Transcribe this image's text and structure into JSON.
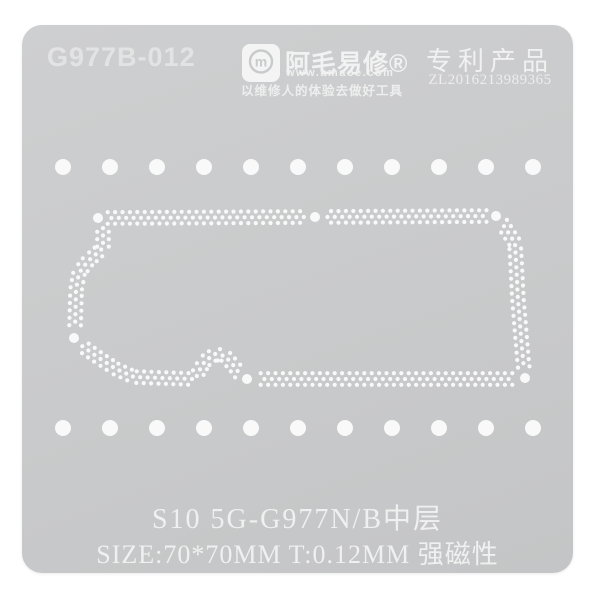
{
  "header": {
    "model_code": "G977B-012",
    "brand": {
      "logo_letter": "m",
      "name": "阿毛易修®",
      "website": "www.amaoe.com",
      "slogan": "以维修人的体验去做好工具"
    },
    "patent_label": "专利产品",
    "patent_number": "ZL2016213989365"
  },
  "caption": {
    "line1": "S10 5G-G977N/B中层",
    "line2": "SIZE:70*70MM T:0.12MM 强磁性"
  },
  "colors": {
    "background": "#ffffff",
    "plate_gray": "#c9cacb",
    "hole_white": "#f9f9f9",
    "text_white": "#f0f0f0"
  },
  "stencil": {
    "hole_rows": {
      "y": [
        167,
        428
      ],
      "x_start": 63,
      "x_step": 47,
      "count": 11,
      "r": 8
    },
    "big_dot_r": 5,
    "big_dots": [
      [
        98,
        218
      ],
      [
        315,
        217
      ],
      [
        496,
        216
      ],
      [
        74,
        338
      ],
      [
        247,
        379
      ],
      [
        525,
        378
      ]
    ],
    "small_dot_r": 2.1,
    "step": 3.7,
    "lane_offset": 5.8,
    "clear_radius": 10.5,
    "paths": [
      [
        [
          104,
          218
        ],
        [
          310,
          217
        ]
      ],
      [
        [
          320,
          217
        ],
        [
          491,
          216
        ]
      ],
      [
        [
          500,
          220
        ],
        [
          515,
          243
        ],
        [
          518,
          300
        ],
        [
          523,
          360
        ],
        [
          524,
          369
        ]
      ],
      [
        [
          516,
          379
        ],
        [
          256,
          379
        ]
      ],
      [
        [
          242,
          377
        ],
        [
          234,
          366
        ],
        [
          225,
          356
        ],
        [
          215,
          354
        ],
        [
          205,
          361
        ],
        [
          199,
          371
        ],
        [
          196,
          378
        ]
      ],
      [
        [
          192,
          379
        ],
        [
          134,
          377
        ],
        [
          116,
          369
        ],
        [
          99,
          358
        ],
        [
          82,
          346
        ]
      ],
      [
        [
          75,
          329
        ],
        [
          76,
          290
        ],
        [
          79,
          273
        ],
        [
          88,
          261
        ],
        [
          103,
          248
        ],
        [
          103,
          227
        ]
      ]
    ]
  }
}
